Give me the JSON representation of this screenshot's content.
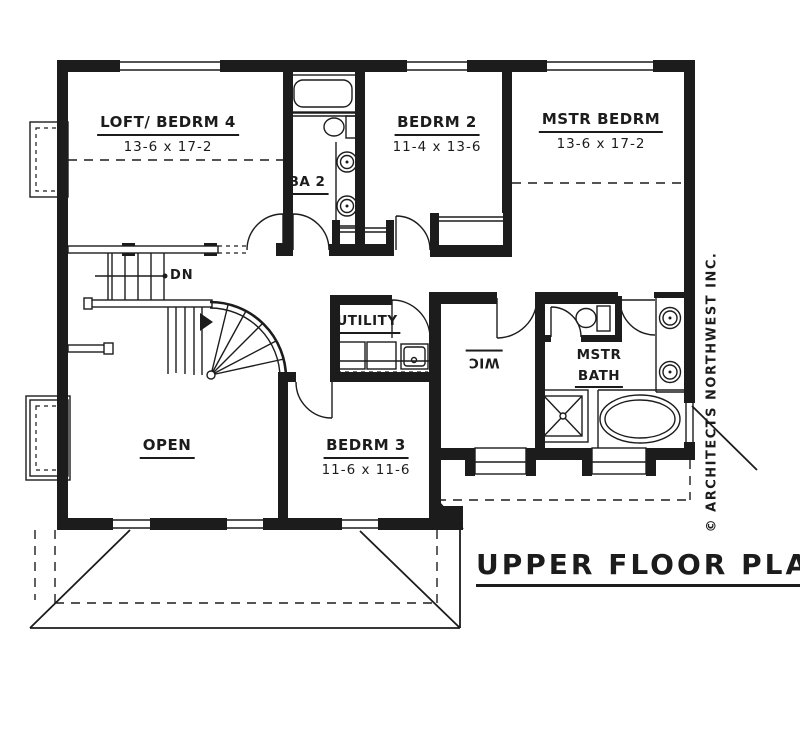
{
  "drawing": {
    "title": "UPPER FLOOR PLAN",
    "credit": "© ARCHITECTS NORTHWEST INC.",
    "stair_label": "DN",
    "rooms": {
      "loft": {
        "name": "LOFT/ BEDRM 4",
        "dims": "13-6 x 17-2"
      },
      "bedrm2": {
        "name": "BEDRM 2",
        "dims": "11-4 x 13-6"
      },
      "mstr_bedrm": {
        "name": "MSTR BEDRM",
        "dims": "13-6 x 17-2"
      },
      "ba2": {
        "name": "BA 2"
      },
      "utility": {
        "name": "UTILITY"
      },
      "wic": {
        "name": "WIC"
      },
      "mstr_bath": {
        "line1": "MSTR",
        "line2": "BATH"
      },
      "open": {
        "name": "OPEN"
      },
      "bedrm3": {
        "name": "BEDRM 3",
        "dims": "11-6 x 11-6"
      }
    },
    "colors": {
      "ink": "#1c1c1c",
      "paper": "#ffffff"
    }
  }
}
